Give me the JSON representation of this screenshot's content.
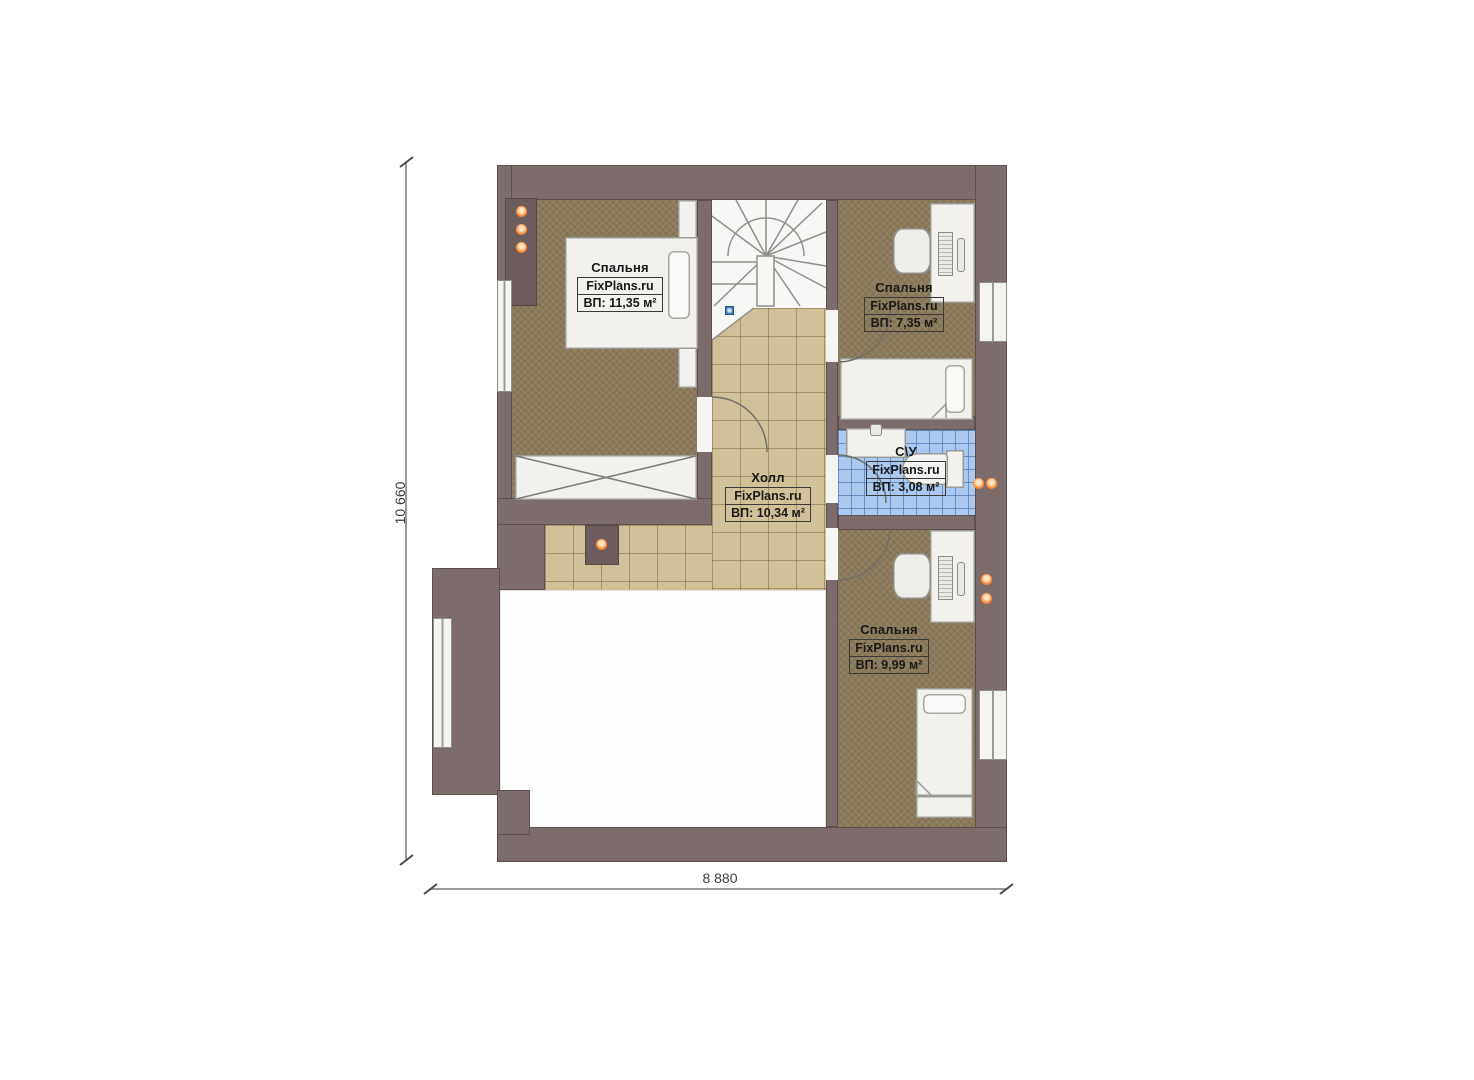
{
  "plan": {
    "type": "floor-plan",
    "brand": "FixPlans.ru",
    "rooms": [
      {
        "id": "bedroom-top-left",
        "name": "Спальня",
        "brand": "FixPlans.ru",
        "area": "ВП: 11,35 м²"
      },
      {
        "id": "bedroom-top-right",
        "name": "Спальня",
        "brand": "FixPlans.ru",
        "area": "ВП: 7,35 м²"
      },
      {
        "id": "hall",
        "name": "Холл",
        "brand": "FixPlans.ru",
        "area": "ВП: 10,34 м²"
      },
      {
        "id": "bathroom",
        "name": "С\\У",
        "brand": "FixPlans.ru",
        "area": "ВП: 3,08 м²"
      },
      {
        "id": "bedroom-bottom",
        "name": "Спальня",
        "brand": "FixPlans.ru",
        "area": "ВП: 9,99 м²"
      }
    ],
    "dimensions": {
      "vertical": "10 660",
      "horizontal": "8 880"
    },
    "colors": {
      "wall": "#7c6c6b",
      "carpet": "#8b7a5c",
      "hall_tile": "#d1c199",
      "bath_tile": "#abc9ee",
      "light_orange": "#ff8a35",
      "marker_blue": "#3f80c2"
    }
  }
}
